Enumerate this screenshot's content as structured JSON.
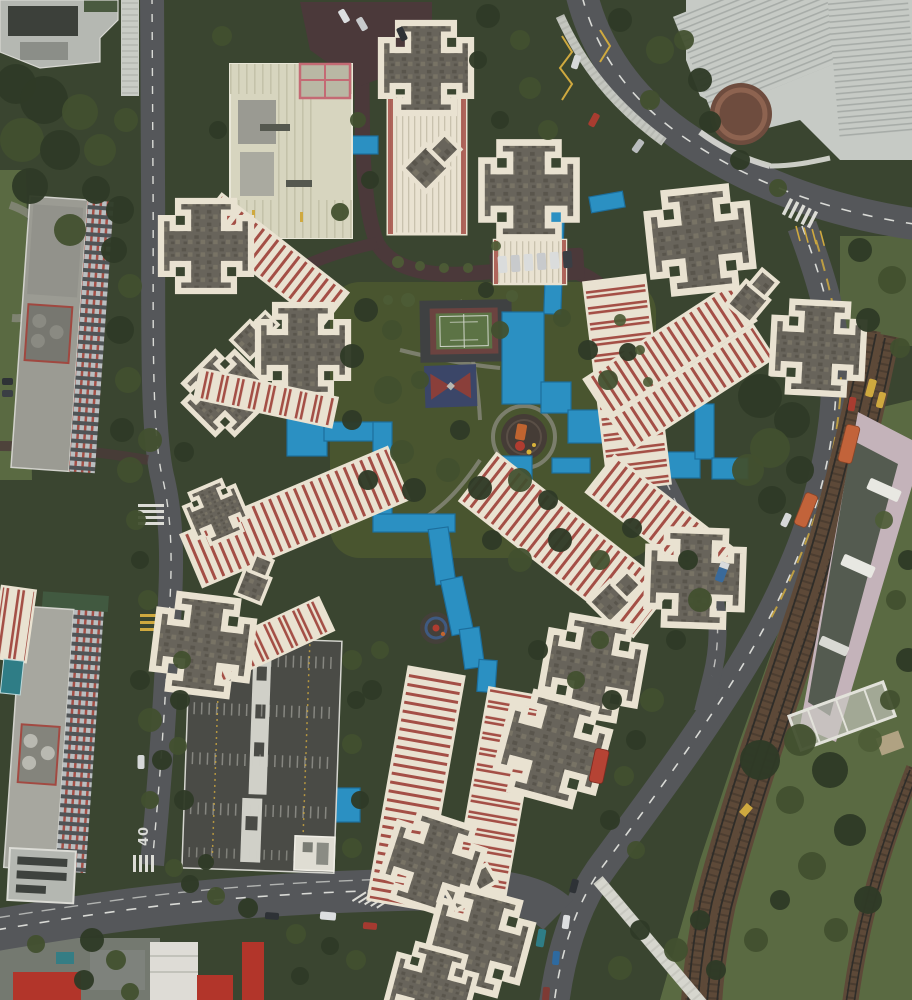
{
  "scene": {
    "type": "aerial-drone-photograph",
    "description": "Top-down aerial view of a high-rise public housing estate: cruciform apartment towers with dark rooftops and red-and-white striped vault facades arranged around a central green courtyard, linked by bright blue covered walkways; tennis court, basketball pad and round playgrounds in the courtyard; rooftop car park, slab apartment blocks and a school podium on the left; curving roads with orange buses; a railway corridor with station roof at the lower right; dense tree canopy throughout."
  },
  "road_markings": {
    "speed_limit": "40"
  },
  "colors": {
    "vegetation": "#3a4530",
    "lawn": "#5a6a42",
    "canopy_1": "#2f3a26",
    "canopy_2": "#42502f",
    "canopy_3": "#4d5c36",
    "road": "#55575a",
    "road_dash": "#d9dad6",
    "estate_road": "#4b393a",
    "path": "#8c8c82",
    "cream": "#e9e2d1",
    "roof_base": "#68645b",
    "roof_dark": "#59554c",
    "roof_light": "#787365",
    "stripe_red": "#a44f46",
    "walkway_blue": "#2b90c2",
    "walkway_edge": "#1c6e9c",
    "court_green": "#5c7345",
    "court_border": "#6b4340",
    "bball_blue": "#3b4668",
    "carpark": "#4a4b46",
    "concrete_light": "#c6cac5",
    "concrete_mid": "#9b9b93",
    "station_edge": "#c4b3ba",
    "station_center": "#4e564a",
    "ballast": "#5d4938",
    "rail_dark": "#2f2d29",
    "marking_yellow": "#cfa93f",
    "bus_orange": "#c2633a",
    "bus_red": "#b54334",
    "red_roof": "#b2352a",
    "white_paint": "#dcdcd6",
    "window_dark": "#505456",
    "glass": "#b9bec0",
    "plaza_brown": "#6e4c3e",
    "teal": "#2f7d86",
    "podium": "#d7d5bf",
    "podium_gray": "#9a9a92",
    "sleeper": "#3e3329"
  }
}
